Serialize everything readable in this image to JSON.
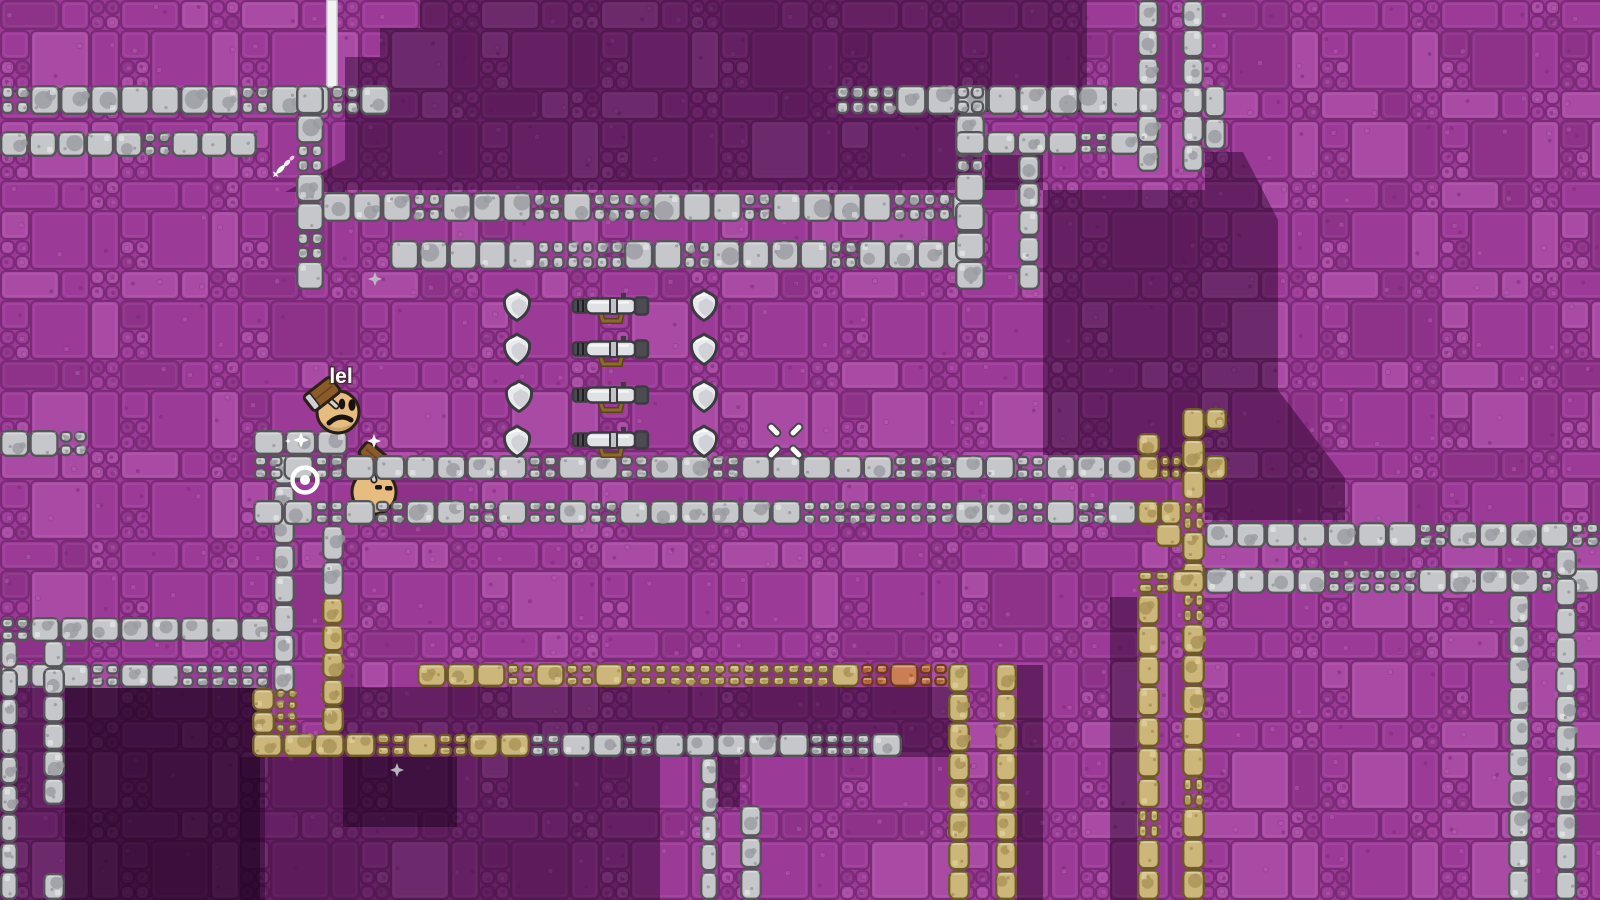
{
  "hud": {
    "player_name": "lel"
  },
  "palette": {
    "bg_base": "#9c3a98",
    "bg_light": "#a94ba5",
    "bg_dark": "#8d3189",
    "bg_grout": "#7a2a76",
    "bg_speck": "#b55fb1",
    "shadow_medium": "rgba(36,2,40,0.46)",
    "shadow_deep": "rgba(25,1,28,0.5)",
    "gray": {
      "base": "#c6c7ca",
      "patch": "#9a9ba0",
      "stroke": "#55555a",
      "hi": "#eef0f2"
    },
    "tan": {
      "base": "#cdb67a",
      "patch": "#aa9356",
      "stroke": "#6d5a28",
      "hi": "#e8d9a8"
    },
    "orange": {
      "base": "#c97e53",
      "patch": "#ad5c33",
      "stroke": "#6e3a1e",
      "hi": "#e5a87c"
    },
    "skin": "#e7bc7f",
    "outline": "#2b2118",
    "wood": "#8a5a28",
    "metal": "#cfd0d3",
    "white": "#f5f5f5",
    "item_light": "#e9eaec",
    "item_shade": "#c9ccd2",
    "item_dark": "#4b4b51",
    "item_stroke": "#3b3b41",
    "strap": "#8a6a2e",
    "strap_stroke": "#5c421a"
  },
  "platforms": [
    {
      "x": 0,
      "y": 85,
      "w": 390,
      "h": 30,
      "m": "gray"
    },
    {
      "x": 0,
      "y": 131,
      "w": 257,
      "h": 26,
      "m": "gray"
    },
    {
      "x": 296,
      "y": 85,
      "w": 28,
      "h": 205,
      "m": "gray"
    },
    {
      "x": 322,
      "y": 192,
      "w": 660,
      "h": 30,
      "m": "gray"
    },
    {
      "x": 390,
      "y": 240,
      "w": 585,
      "h": 30,
      "m": "gray"
    },
    {
      "x": 835,
      "y": 85,
      "w": 305,
      "h": 30,
      "m": "gray"
    },
    {
      "x": 955,
      "y": 85,
      "w": 30,
      "h": 205,
      "m": "gray"
    },
    {
      "x": 955,
      "y": 131,
      "w": 185,
      "h": 24,
      "m": "gray"
    },
    {
      "x": 1018,
      "y": 155,
      "w": 22,
      "h": 135,
      "m": "gray"
    },
    {
      "x": 1137,
      "y": 0,
      "w": 22,
      "h": 172,
      "m": "gray"
    },
    {
      "x": 1182,
      "y": 0,
      "w": 22,
      "h": 172,
      "m": "gray"
    },
    {
      "x": 1204,
      "y": 85,
      "w": 22,
      "h": 65,
      "m": "gray"
    },
    {
      "x": 0,
      "y": 430,
      "w": 88,
      "h": 27,
      "m": "gray"
    },
    {
      "x": 273,
      "y": 455,
      "w": 22,
      "h": 238,
      "m": "gray"
    },
    {
      "x": 322,
      "y": 525,
      "w": 22,
      "h": 72,
      "m": "gray"
    },
    {
      "x": 322,
      "y": 597,
      "w": 22,
      "h": 136,
      "m": "tan"
    },
    {
      "x": 0,
      "y": 617,
      "w": 270,
      "h": 25,
      "m": "gray"
    },
    {
      "x": 0,
      "y": 663,
      "w": 270,
      "h": 25,
      "m": "gray"
    },
    {
      "x": 0,
      "y": 640,
      "w": 18,
      "h": 260,
      "m": "gray"
    },
    {
      "x": 43,
      "y": 640,
      "w": 22,
      "h": 165,
      "m": "gray"
    },
    {
      "x": 43,
      "y": 873,
      "w": 22,
      "h": 27,
      "m": "gray"
    },
    {
      "x": 252,
      "y": 688,
      "w": 46,
      "h": 46,
      "m": "tan"
    },
    {
      "x": 252,
      "y": 733,
      "w": 278,
      "h": 24,
      "m": "tan"
    },
    {
      "x": 530,
      "y": 733,
      "w": 372,
      "h": 24,
      "m": "gray"
    },
    {
      "x": 700,
      "y": 757,
      "w": 18,
      "h": 143,
      "m": "gray"
    },
    {
      "x": 740,
      "y": 805,
      "w": 22,
      "h": 95,
      "m": "gray"
    },
    {
      "x": 417,
      "y": 663,
      "w": 443,
      "h": 24,
      "m": "tan"
    },
    {
      "x": 860,
      "y": 663,
      "w": 88,
      "h": 24,
      "m": "orange"
    },
    {
      "x": 948,
      "y": 663,
      "w": 22,
      "h": 237,
      "m": "tan"
    },
    {
      "x": 995,
      "y": 663,
      "w": 22,
      "h": 237,
      "m": "tan"
    },
    {
      "x": 1137,
      "y": 433,
      "w": 23,
      "h": 22,
      "m": "tan"
    },
    {
      "x": 1137,
      "y": 455,
      "w": 45,
      "h": 25,
      "m": "tan"
    },
    {
      "x": 1205,
      "y": 455,
      "w": 22,
      "h": 25,
      "m": "tan"
    },
    {
      "x": 1137,
      "y": 500,
      "w": 45,
      "h": 25,
      "m": "tan"
    },
    {
      "x": 1155,
      "y": 523,
      "w": 27,
      "h": 24,
      "m": "tan"
    },
    {
      "x": 1182,
      "y": 408,
      "w": 23,
      "h": 492,
      "m": "tan"
    },
    {
      "x": 1205,
      "y": 408,
      "w": 22,
      "h": 22,
      "m": "tan"
    },
    {
      "x": 1205,
      "y": 522,
      "w": 395,
      "h": 26,
      "m": "gray"
    },
    {
      "x": 1137,
      "y": 570,
      "w": 68,
      "h": 24,
      "m": "tan"
    },
    {
      "x": 1205,
      "y": 568,
      "w": 395,
      "h": 26,
      "m": "gray"
    },
    {
      "x": 1137,
      "y": 594,
      "w": 23,
      "h": 306,
      "m": "tan"
    },
    {
      "x": 1508,
      "y": 594,
      "w": 22,
      "h": 306,
      "m": "gray"
    },
    {
      "x": 1555,
      "y": 548,
      "w": 22,
      "h": 352,
      "m": "gray"
    },
    {
      "x": 253,
      "y": 430,
      "w": 95,
      "h": 25,
      "m": "gray",
      "front": true
    },
    {
      "x": 253,
      "y": 455,
      "w": 884,
      "h": 25,
      "m": "gray",
      "front": true
    },
    {
      "x": 253,
      "y": 500,
      "w": 884,
      "h": 25,
      "m": "gray",
      "front": true
    }
  ],
  "shadows": {
    "medium": [
      {
        "rect": [
          420,
          0,
          562,
          190
        ]
      },
      {
        "rect": [
          380,
          28,
          40,
          162
        ]
      },
      {
        "rect": [
          345,
          57,
          35,
          133
        ]
      },
      {
        "rect": [
          982,
          0,
          105,
          112
        ]
      },
      {
        "rect": [
          985,
          155,
          58,
          35
        ]
      },
      {
        "poly": [
          [
            1043,
            190
          ],
          [
            1205,
            190
          ],
          [
            1205,
            152
          ],
          [
            1243,
            152
          ],
          [
            1278,
            220
          ],
          [
            1278,
            390
          ],
          [
            1345,
            478
          ],
          [
            1345,
            520
          ],
          [
            1205,
            520
          ],
          [
            1205,
            477
          ],
          [
            1158,
            477
          ],
          [
            1158,
            455
          ],
          [
            1043,
            455
          ]
        ]
      },
      {
        "poly": [
          [
            285,
            192
          ],
          [
            345,
            192
          ],
          [
            345,
            160
          ]
        ]
      },
      {
        "rect": [
          0,
          688,
          265,
          212
        ]
      },
      {
        "rect": [
          325,
          687,
          635,
          70
        ]
      },
      {
        "rect": [
          240,
          757,
          420,
          143
        ]
      },
      {
        "rect": [
          717,
          757,
          23,
          50
        ]
      },
      {
        "rect": [
          1017,
          665,
          26,
          235
        ]
      },
      {
        "rect": [
          1110,
          597,
          27,
          303
        ]
      }
    ],
    "deep": [
      {
        "rect": [
          65,
          688,
          195,
          212
        ]
      },
      {
        "rect": [
          343,
          757,
          114,
          70
        ]
      }
    ]
  },
  "items": {
    "shield_positions": [
      {
        "x": 517,
        "y": 304
      },
      {
        "x": 704,
        "y": 304
      },
      {
        "x": 517,
        "y": 348
      },
      {
        "x": 704,
        "y": 348
      },
      {
        "x": 519,
        "y": 395
      },
      {
        "x": 704,
        "y": 395
      },
      {
        "x": 517,
        "y": 440
      },
      {
        "x": 704,
        "y": 440
      }
    ],
    "bazooka_positions": [
      {
        "x": 610,
        "y": 306
      },
      {
        "x": 610,
        "y": 349
      },
      {
        "x": 610,
        "y": 395
      },
      {
        "x": 610,
        "y": 440
      }
    ]
  },
  "characters": [
    {
      "id": "player",
      "x": 338,
      "y": 412,
      "r": 21,
      "eyes": "open",
      "mouth": "frown",
      "front": true,
      "label": true,
      "hammer": {
        "x": 322,
        "y": 394,
        "angle": -38,
        "w": 34,
        "h": 19,
        "band": "start"
      },
      "handle": [
        [
          336,
          406
        ],
        [
          326,
          397
        ]
      ]
    },
    {
      "id": "enemy",
      "x": 374,
      "y": 492,
      "r": 22,
      "eyes": "squint",
      "mouth": "none",
      "front": false,
      "label": false,
      "hammer": {
        "x": 374,
        "y": 456,
        "angle": 40,
        "w": 29,
        "h": 16,
        "band": "end"
      },
      "handle": [
        [
          369,
          464
        ],
        [
          374,
          480
        ]
      ]
    }
  ],
  "effects": {
    "beam": {
      "x": 327,
      "y": 0,
      "w": 10,
      "h": 87
    },
    "bullseye": {
      "x": 305,
      "y": 480
    },
    "crosshair": {
      "x": 785,
      "y": 441
    },
    "projectile": {
      "x": 287,
      "y": 163,
      "angle": 135
    },
    "sparkles": [
      {
        "x": 301,
        "y": 440,
        "r": 8,
        "c": "white"
      },
      {
        "x": 374,
        "y": 441,
        "r": 7,
        "c": "white"
      },
      {
        "x": 288,
        "y": 441,
        "r": 3,
        "c": "white"
      },
      {
        "x": 375,
        "y": 279,
        "r": 7,
        "c": "gray"
      },
      {
        "x": 397,
        "y": 770,
        "r": 7,
        "c": "gray"
      }
    ]
  }
}
